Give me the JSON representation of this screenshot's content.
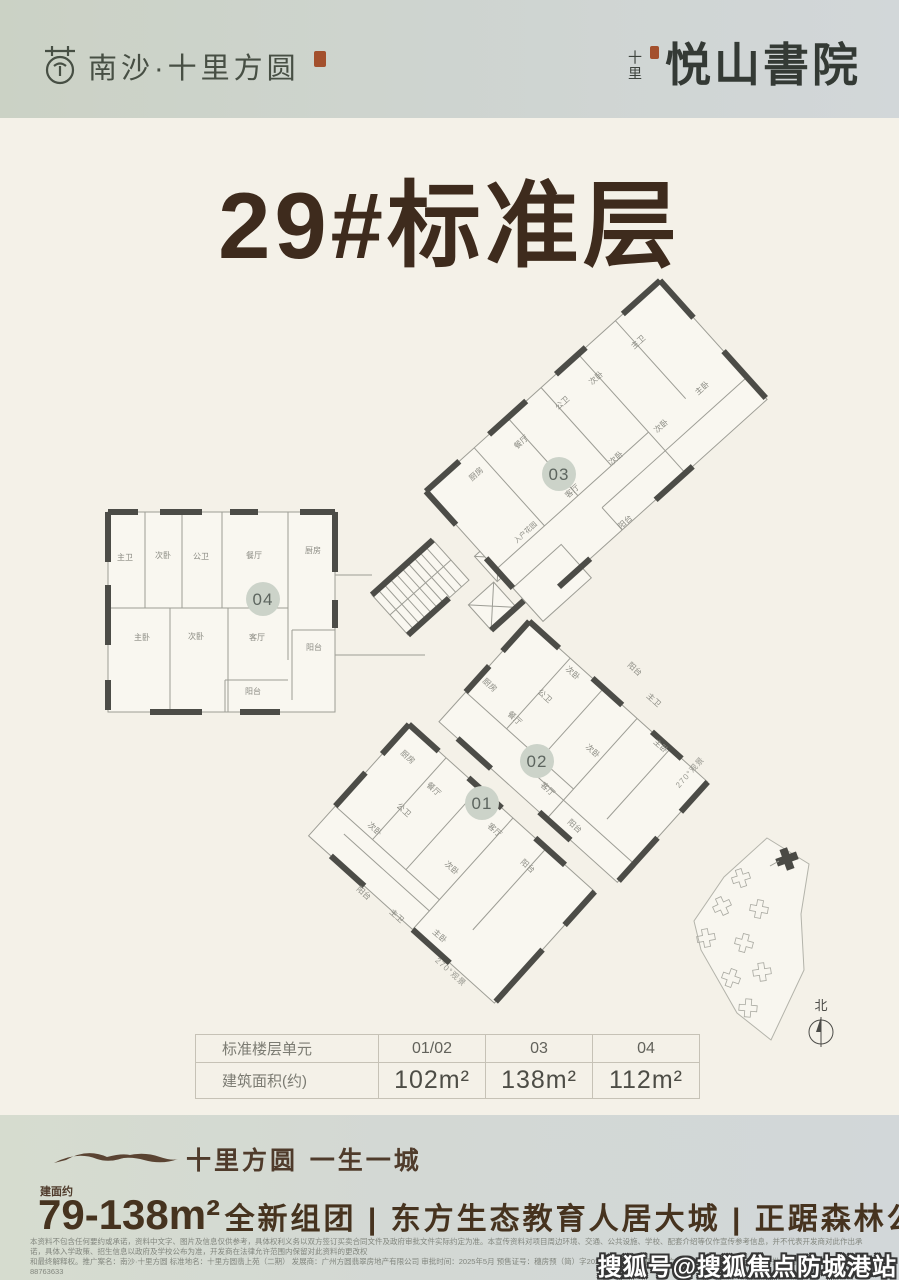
{
  "header": {
    "brand_left_name": "南沙·十里方圆",
    "brand_right_prefix": "十里",
    "brand_right_name": "悦山書院"
  },
  "title": "29#标准层",
  "floorplan": {
    "badges": {
      "u01": "01",
      "u02": "02",
      "u03": "03",
      "u04": "04"
    },
    "u04_rooms": [
      "主卫",
      "次卧",
      "公卫",
      "餐厅",
      "厨房",
      "主卧",
      "次卧",
      "客厅",
      "阳台",
      "阳台"
    ],
    "u03_rooms": [
      "餐厅",
      "公卫",
      "次卧",
      "主卫",
      "主卧",
      "次卧",
      "次卧",
      "厨房",
      "客厅",
      "阳台"
    ],
    "u03_entry": "入户花园",
    "u02_rooms": [
      "厨房",
      "公卫",
      "次卧",
      "餐厅",
      "次卧",
      "客厅",
      "主卫",
      "主卧",
      "阳台",
      "阳台"
    ],
    "u01_rooms": [
      "厨房",
      "餐厅",
      "公卫",
      "次卧",
      "客厅",
      "次卧",
      "阳台",
      "主卫",
      "主卧",
      "阳台"
    ],
    "view_note_01": "270°观景",
    "view_note_02": "270°观景",
    "north_label": "北"
  },
  "table": {
    "row1_label": "标准楼层单元",
    "row1_cols": [
      "01/02",
      "03",
      "04"
    ],
    "row2_label": "建筑面积(约)",
    "row2_cols": [
      "102m²",
      "138m²",
      "112m²"
    ]
  },
  "footer": {
    "slogan": "十里方圆 一生一城",
    "area_prefix": "建面约",
    "area_range": "79-138m²",
    "tagline": "全新组团 | 东方生态教育人居大城 | 正踞森林公园前排",
    "disclaimer_line1": "本资料不包含任何要约或承诺，资料中文字、图片及信息仅供参考，具体权利义务以双方签订买卖合同文件及政府审批文件实际约定为准。本宣传资料对项目周边环境、交通、公共设施、学校、配套介绍等仅作宣传参考信息，并不代表开发商对此作出承诺，具体入学政策、招生信息以政府及学校公布为准，开发商在法律允许范围内保留对此资料的更改权",
    "disclaimer_line2": "和最终解释权。推广案名：南沙·十里方圆 标准地名：十里方圆翡上苑（二期） 发展商：广州方圆翡翠房地产有限公司 审批时间：2025年5月 预售证号：穗房预（简）字20220466号 发证机关：广州南沙经济技术开发区行政审批局 咨询建议热线：181-88763633",
    "watermark": "搜狐号@搜狐焦点防城港站"
  }
}
